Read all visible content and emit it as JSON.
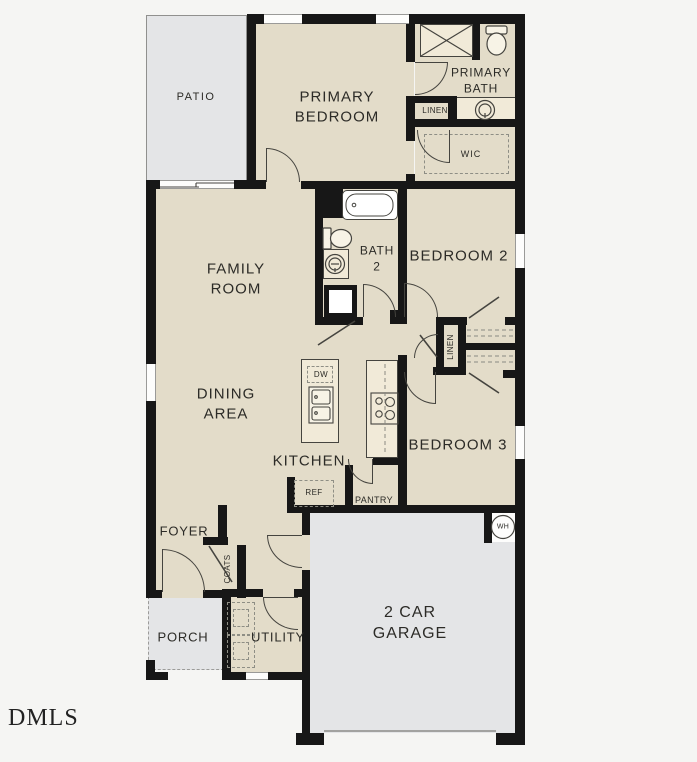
{
  "watermark": "DMLS",
  "colors": {
    "background": "#f5f5f3",
    "floor": "#e3dcc9",
    "outdoor": "#e4e5e7",
    "wall": "#171717",
    "fixture": "#f1ead8",
    "line": "#3d3d38"
  },
  "plan": {
    "labels": {
      "patio": "PATIO",
      "primary_bedroom": "PRIMARY\nBEDROOM",
      "primary_bath": "PRIMARY\nBATH",
      "linen_bath": "LINEN",
      "wic": "WIC",
      "family_room": "FAMILY\nROOM",
      "bath2": "BATH\n2",
      "bedroom2": "BEDROOM 2",
      "linen_hall": "LINEN",
      "dining": "DINING\nAREA",
      "kitchen": "KITCHEN",
      "dishwasher": "DW",
      "refrigerator": "REF",
      "pantry": "PANTRY",
      "bedroom3": "BEDROOM 3",
      "foyer": "FOYER",
      "coats": "COATS",
      "porch": "PORCH",
      "utility": "UTILITY",
      "garage": "2 CAR\nGARAGE",
      "water_heater": "WH"
    }
  }
}
